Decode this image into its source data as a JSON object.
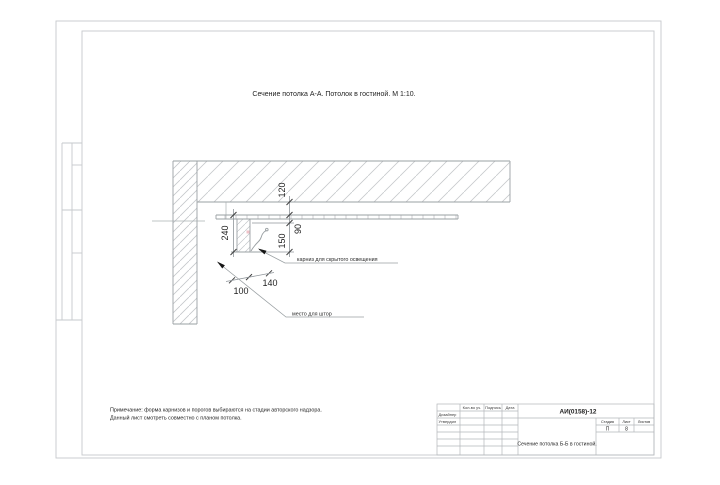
{
  "page": {
    "title_text": "Сечение потолка А-А. Потолок в гостиной. М 1:10."
  },
  "drawing": {
    "dimensions": {
      "ceiling_offset": "120",
      "ledge_drop": "90",
      "box_height": "240",
      "cove_height": "150",
      "curtain_space_width": "100",
      "box_width": "140"
    },
    "callouts": {
      "cornice": "карниз для скрытого освещения",
      "curtains": "место для штор"
    }
  },
  "notes": {
    "line1": "Примечание: форма карнизов и порогов выбираются на стадии авторского надзора.",
    "line2": "Данный лист смотреть совместно с планом потолка."
  },
  "title_block": {
    "doc_number": "АИ(0158)-12",
    "headers": {
      "count": "Кол-во уч.",
      "signature": "Подпись",
      "date": "Дата",
      "stage": "Стадия",
      "sheet": "Лист",
      "sheets": "Листов"
    },
    "roles": {
      "designer": "Дизайнер",
      "approved": "Утвердил"
    },
    "values": {
      "stage": "П",
      "sheet": "8"
    },
    "drawing_title": "Сечение потолка Б-Б в гостиной."
  },
  "colors": {
    "main_line": "#9aa0a3",
    "hatch": "#c4c7cb",
    "dim_text": "#1f1f1f",
    "accent_pink": "#efc2c8"
  },
  "icons": {
    "leader_arrow": "filled-triangle"
  }
}
